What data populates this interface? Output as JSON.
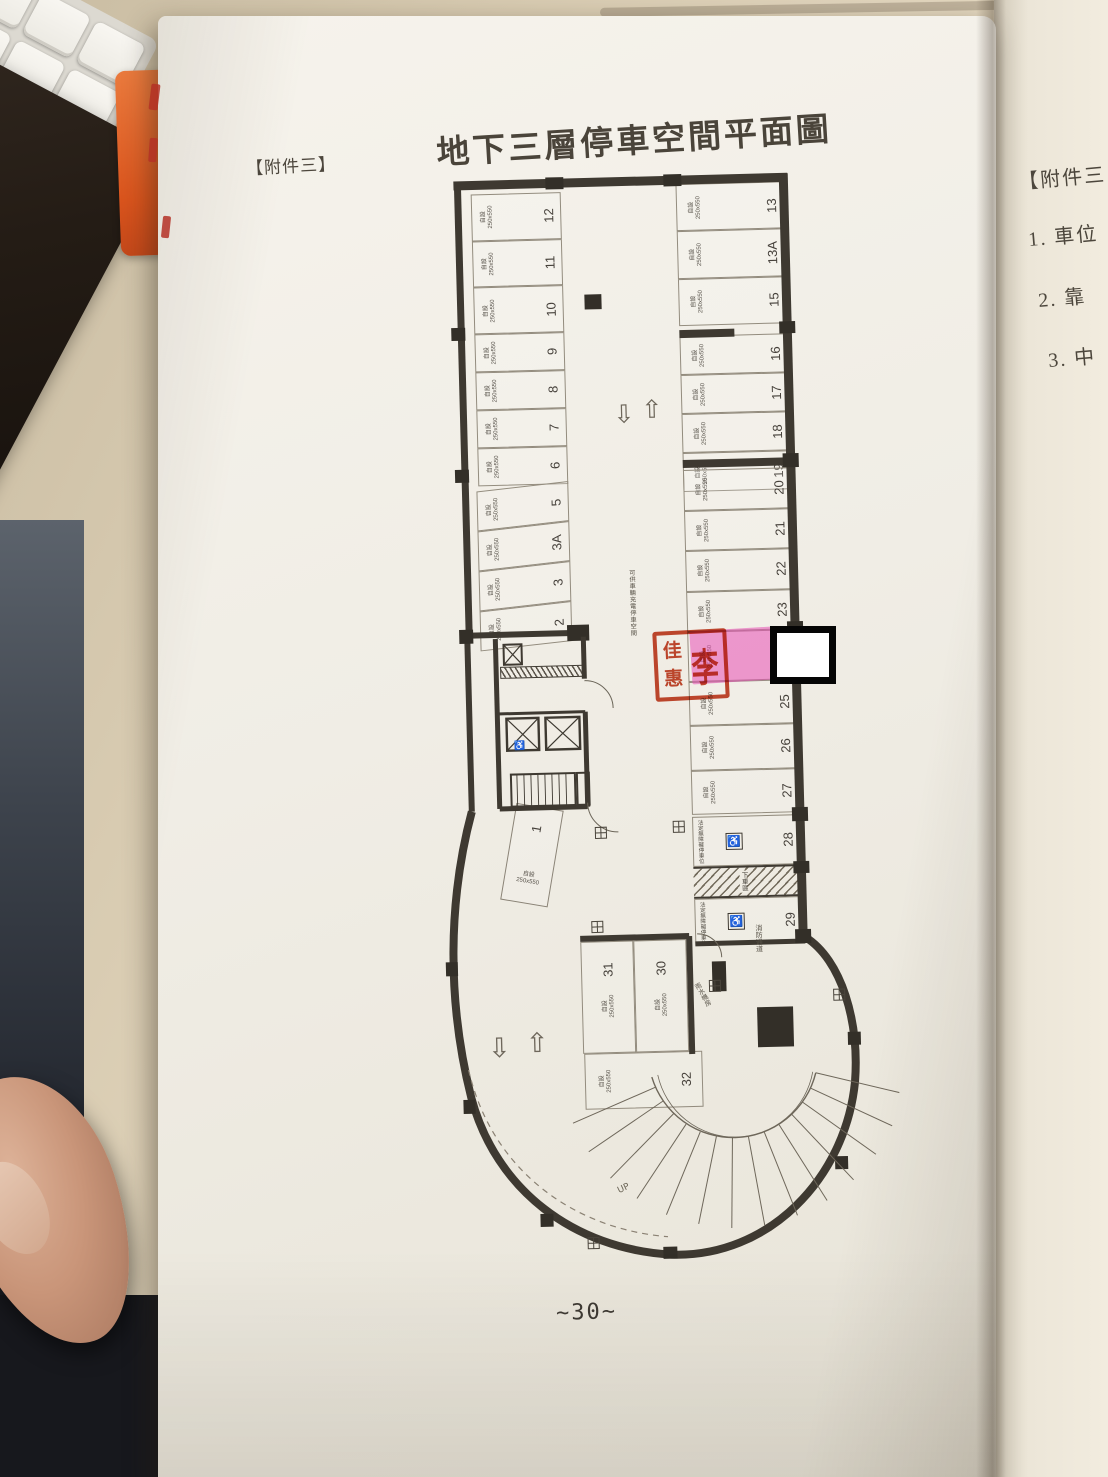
{
  "page": {
    "attachment_label": "【附件三】",
    "title": "地下三層停車空間平面圖",
    "page_number": "~30~"
  },
  "next_page": {
    "attachment_label": "【附件三",
    "items": [
      "1. 車位",
      "2. 靠",
      "3. 中"
    ]
  },
  "plan": {
    "spec_label": "自設",
    "spec_size": "250x550",
    "columns": {
      "left_a": [
        "12",
        "11",
        "10"
      ],
      "left_b": [
        "9",
        "8",
        "7",
        "6"
      ],
      "left_c": [
        "5",
        "3A",
        "3",
        "2"
      ],
      "right_a": [
        "13",
        "13A",
        "15"
      ],
      "right_b": [
        "16",
        "17",
        "18",
        "19"
      ],
      "right_c": [
        "20",
        "21",
        "22",
        "23"
      ],
      "right_d": [
        "25",
        "26",
        "27"
      ],
      "bottom": [
        "31",
        "30"
      ]
    },
    "stall_23a": "23A",
    "stall_28": "28",
    "stall_29": "29",
    "stall_32": "32",
    "stall_1": "1",
    "labels": {
      "charging_space": "可供車輛充電停車空間",
      "accessible_space": "法定無障礙停車位",
      "dropoff_zone": "下車區",
      "rainwater_room": "雨水機房",
      "fire_lane": "消防通道",
      "up": "UP",
      "wheelchair_icon": "♿",
      "arrow_up": "⇧",
      "arrow_down": "⇩"
    },
    "stamp": {
      "right_char": "李",
      "left_chars": "佳惠",
      "color": "#c23a1e"
    },
    "highlight_color": "#e84fb5",
    "wall_color": "#3e3931"
  }
}
